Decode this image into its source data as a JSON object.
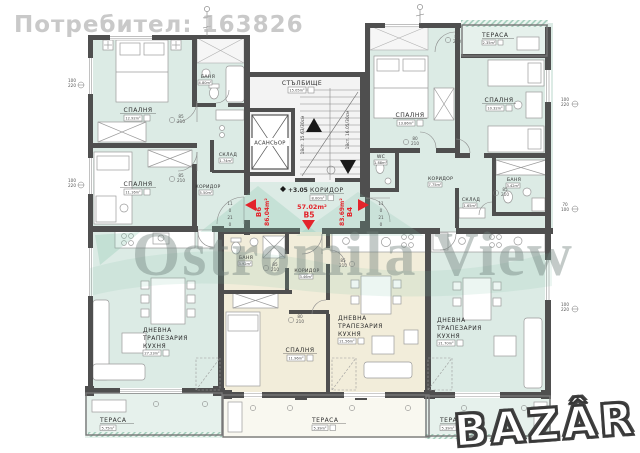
{
  "watermarks": {
    "user": "Потребител: 163826",
    "agency": "Ostromila View",
    "logo": "BAZÂR"
  },
  "common": {
    "staircase": {
      "name": "СТЪЛБИЩЕ",
      "area": "15.05m²"
    },
    "elevator": {
      "name": "АСАНСЬОР"
    },
    "corridor": {
      "name": "КОРИДОР",
      "area": "8.00m²"
    },
    "elevation": "+3.05",
    "stair_note_left": "18ст. 15.63/30см",
    "stair_note_right": "18ст. 16.05/30см",
    "steps_left": [
      "11",
      "0",
      "21",
      "0"
    ],
    "steps_right": [
      "11",
      "0",
      "21",
      "0"
    ]
  },
  "apartments": {
    "b6": {
      "id": "В6",
      "total": "86.04m²",
      "bedroom1": {
        "name": "СПАЛНЯ",
        "area": "12.92m²"
      },
      "bedroom2": {
        "name": "СПАЛНЯ",
        "area": "11.16m²"
      },
      "bath": {
        "name": "БАНЯ",
        "area": "4.80m²"
      },
      "storage": {
        "name": "СКЛАД",
        "area": "1.74m²"
      },
      "corridor": {
        "name": "КОРИДОР",
        "area": "5.50m²"
      },
      "living": {
        "lines": [
          "ДНЕВНА",
          "ТРАПЕЗАРИЯ",
          "КУХНЯ"
        ],
        "area": "27.23m²"
      },
      "terrace": {
        "name": "ТЕРАСА",
        "area": "5.75m²"
      }
    },
    "b5": {
      "id": "В5",
      "total": "57.02m²",
      "bath": {
        "name": "БАНЯ",
        "area": "3.92m²"
      },
      "corridor": {
        "name": "КОРИДОР",
        "area": "3.46m²"
      },
      "bedroom": {
        "name": "СПАЛНЯ",
        "area": "11.96m²"
      },
      "living": {
        "lines": [
          "ДНЕВНА",
          "ТРАПЕЗАРИЯ",
          "КУХНЯ"
        ],
        "area": "21.56m²"
      },
      "terrace": {
        "name": "ТЕРАСА",
        "area": "5.39m²"
      }
    },
    "b4": {
      "id": "В4",
      "total": "83.69m²",
      "terrace_top": {
        "name": "ТЕРАСА",
        "area": "2.35m²"
      },
      "bedroom1": {
        "name": "СПАЛНЯ",
        "area": "13.86m²"
      },
      "bedroom2": {
        "name": "СПАЛНЯ",
        "area": "10.32m²"
      },
      "wc": {
        "name": "WC",
        "area": "1.88m²"
      },
      "corridor": {
        "name": "КОРИДОР",
        "area": "7.75m²"
      },
      "storage": {
        "name": "СКЛАД",
        "area": "1.65m²"
      },
      "bath": {
        "name": "БАНЯ",
        "area": "3.42m²"
      },
      "living": {
        "lines": [
          "ДНЕВНА",
          "ТРАПЕЗАРИЯ",
          "КУХНЯ"
        ],
        "area": "21.70m²"
      },
      "terrace": {
        "name": "ТЕРАСА",
        "area": "5.39m²"
      }
    }
  },
  "dims": {
    "door85": {
      "w": "85",
      "h": "210"
    },
    "door80": {
      "w": "80",
      "h": "210"
    },
    "door85_240": {
      "w": "85",
      "h": "240"
    },
    "win100": {
      "w": "100",
      "h": "220"
    },
    "win70": {
      "w": "70",
      "h": "100"
    }
  }
}
